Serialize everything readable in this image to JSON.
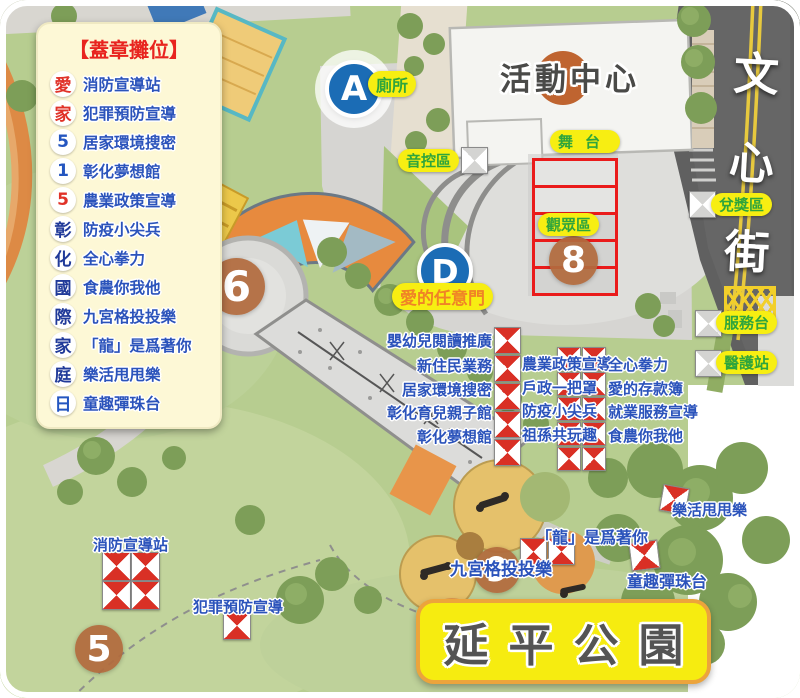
{
  "legend": {
    "title": "【蓋章攤位】",
    "items": [
      {
        "badge": "愛",
        "color": "#e03228",
        "label": "消防宣導站"
      },
      {
        "badge": "家",
        "color": "#e03228",
        "label": "犯罪預防宣導"
      },
      {
        "badge": "5",
        "color": "#2456c0",
        "label": "居家環境搜密"
      },
      {
        "badge": "1",
        "color": "#2456c0",
        "label": "彰化夢想館"
      },
      {
        "badge": "5",
        "color": "#e03228",
        "label": "農業政策宣導"
      },
      {
        "badge": "彰",
        "color": "#203a99",
        "label": "防疫小尖兵"
      },
      {
        "badge": "化",
        "color": "#203a99",
        "label": "全心拳力"
      },
      {
        "badge": "國",
        "color": "#203a99",
        "label": "食農你我他"
      },
      {
        "badge": "際",
        "color": "#203a99",
        "label": "九宮格投投樂"
      },
      {
        "badge": "家",
        "color": "#203a99",
        "label": "「龍」是爲著你"
      },
      {
        "badge": "庭",
        "color": "#203a99",
        "label": "樂活甩甩樂"
      },
      {
        "badge": "日",
        "color": "#2456c0",
        "label": "童趣彈珠台"
      }
    ]
  },
  "street": {
    "name": "文心街"
  },
  "building": {
    "label": "活動中心"
  },
  "park": {
    "title": "延平公園"
  },
  "markers": {
    "a": {
      "letter": "A",
      "caption": "廁所"
    },
    "d": {
      "letter": "D",
      "caption": "愛的任意門"
    }
  },
  "numbers": {
    "n5": "5",
    "n6": "6",
    "n8": "8",
    "n9": "9"
  },
  "zones": {
    "sound_control": "音控區",
    "stage": "舞台",
    "audience": "觀眾區",
    "prize": "兌獎區",
    "service": "服務台",
    "medical": "醫護站"
  },
  "booths": {
    "col_left": [
      "嬰幼兒閱讀推廣",
      "新住民業務",
      "居家環境搜密",
      "彰化育兒親子館",
      "彰化夢想館"
    ],
    "col_mid": [
      "農業政策宣導",
      "戶政一把罩",
      "防疫小尖兵",
      "祖孫共玩趣"
    ],
    "col_right": [
      "全心拳力",
      "愛的存款簿",
      "就業服務宣導",
      "食農你我他"
    ],
    "fire": "消防宣導站",
    "crime": "犯罪預防宣導",
    "nine_grid": "九宮格投投樂",
    "dragon": "「龍」是爲著你",
    "marble": "童趣彈珠台",
    "swing": "樂活甩甩樂"
  },
  "colors": {
    "badge_red": "#e03228",
    "badge_blue": "#2456c0",
    "badge_navy": "#203a99",
    "pill_bg": "#f7ee12",
    "pill_green": "#2fa53c",
    "pill_orange": "#f08326",
    "booth_blue": "#2b53bb",
    "tent_red": "#d93025",
    "marker_blue": "#1b6cb5",
    "number_brown": "#b26a3d",
    "grid_red": "#ea1b1b",
    "banner_yellow": "#f6ec10",
    "banner_border": "#eca43c"
  }
}
